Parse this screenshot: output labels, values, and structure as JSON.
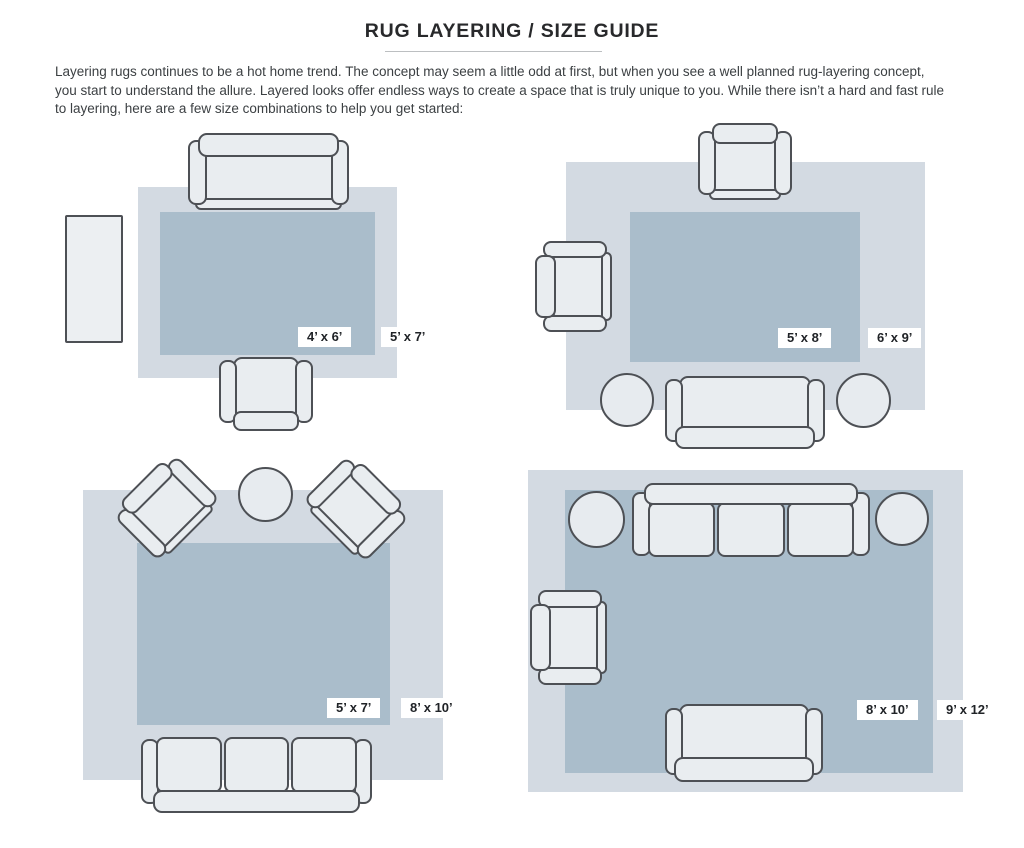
{
  "page": {
    "title": "RUG LAYERING / SIZE GUIDE",
    "intro_lines": [
      "Layering rugs continues to be a hot home trend. The concept may seem a little odd at first, but when you see a well planned rug-layering concept,",
      "you start to understand the allure. Layered looks offer endless ways to create a space that is truly unique to you. While there isn’t a hard and fast rule",
      "to layering, here are a few size combinations to help you get started:"
    ]
  },
  "diagrams": {
    "top_left": {
      "inner_rug_size": "4’ x 6’",
      "outer_rug_size": "5’ x 7’"
    },
    "top_right": {
      "inner_rug_size": "5’ x 8’",
      "outer_rug_size": "6’ x 9’"
    },
    "bottom_left": {
      "inner_rug_size": "5’ x 7’",
      "outer_rug_size": "8’ x 10’"
    },
    "bottom_right": {
      "inner_rug_size": "8’ x 10’",
      "outer_rug_size": "9’ x 12’"
    }
  },
  "colors": {
    "outer_rug": "#d3dae2",
    "inner_rug": "#aabdcb",
    "furniture_fill": "#e9edf0",
    "furniture_outline": "#4d5055",
    "label_background": "#ffffff",
    "label_text": "#202327"
  }
}
